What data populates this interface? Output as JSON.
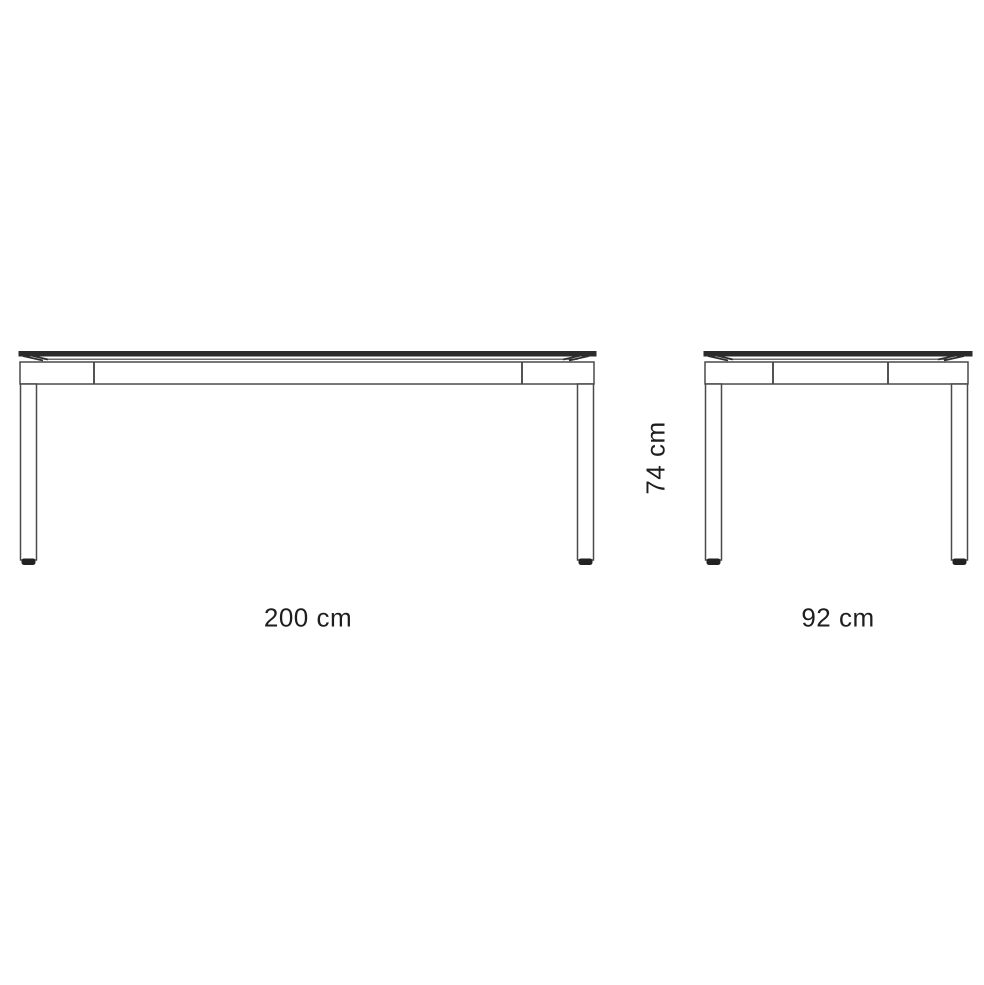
{
  "canvas": {
    "background": "#ffffff",
    "line_color": "#4a4a4a",
    "slab_color": "#2b2b2b",
    "foot_color": "#222222",
    "text_color": "#1e1e1e"
  },
  "diagram": {
    "subject": "table-dimension-drawing",
    "views": {
      "front": {
        "name": "front-elevation",
        "label": "200 cm",
        "dimension_cm": 200
      },
      "side": {
        "name": "side-elevation",
        "label": "92 cm",
        "dimension_cm": 92
      },
      "height": {
        "name": "height-dimension",
        "label": "74 cm",
        "dimension_cm": 74
      }
    }
  }
}
